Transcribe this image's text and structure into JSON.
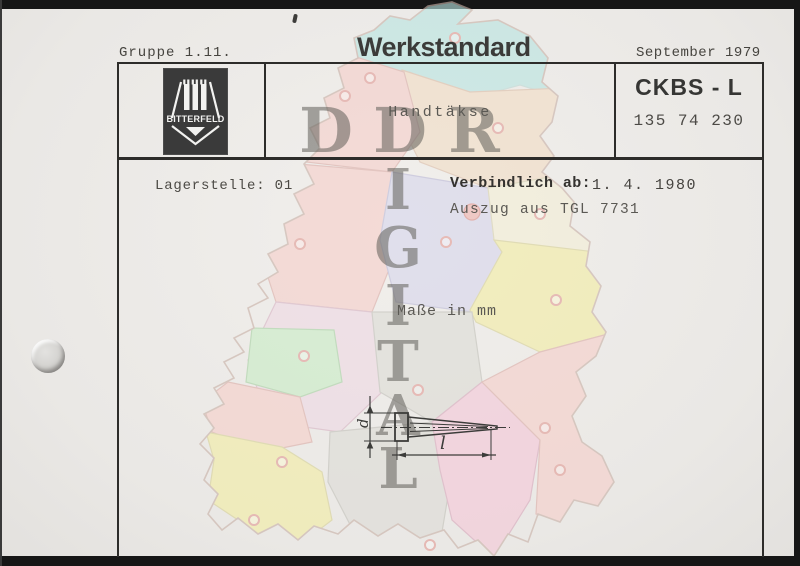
{
  "document": {
    "header": {
      "group": "Gruppe 1.11.",
      "type": "Werkstandard",
      "date": "September 1979"
    },
    "title_block": {
      "logo_name": "BITTERFELD",
      "item_title": "Handtäkse",
      "code": "CKBS - L",
      "item_number": "135 74 230"
    },
    "details": {
      "storage": "Lagerstelle: 01",
      "valid_from_label": "Verbindlich ab:",
      "valid_from_value": "1. 4. 1980",
      "source_note": "Auszug aus TGL 7731",
      "units_note": "Maße in mm"
    },
    "drawing": {
      "diameter_label": "d",
      "length_label": "l"
    }
  },
  "watermark": {
    "row_letters": [
      "D",
      "D",
      "R"
    ],
    "column_letters": [
      "I",
      "G",
      "I",
      "T",
      "A",
      "L"
    ],
    "color": "#605e5a"
  },
  "map": {
    "palette": {
      "cyan": "#b9e5e1",
      "pink": "#f6cfca",
      "rose": "#f5c8d8",
      "lavender": "#d7d6ec",
      "peach": "#f2ddc5",
      "cream": "#f4efd6",
      "yellow": "#f3eda4",
      "green": "#c9ecc6",
      "gray": "#dddcd6",
      "lilac": "#eed9e4",
      "berlin_red": "#efb3ae"
    },
    "capital_ring": "#e29d97",
    "region_border": "#dcaea8",
    "outline": "#c9b2a8"
  },
  "colors": {
    "frame": "#141414",
    "paper": "#eceae7",
    "ink": "#3a3a38",
    "line": "#2d2c2a"
  }
}
